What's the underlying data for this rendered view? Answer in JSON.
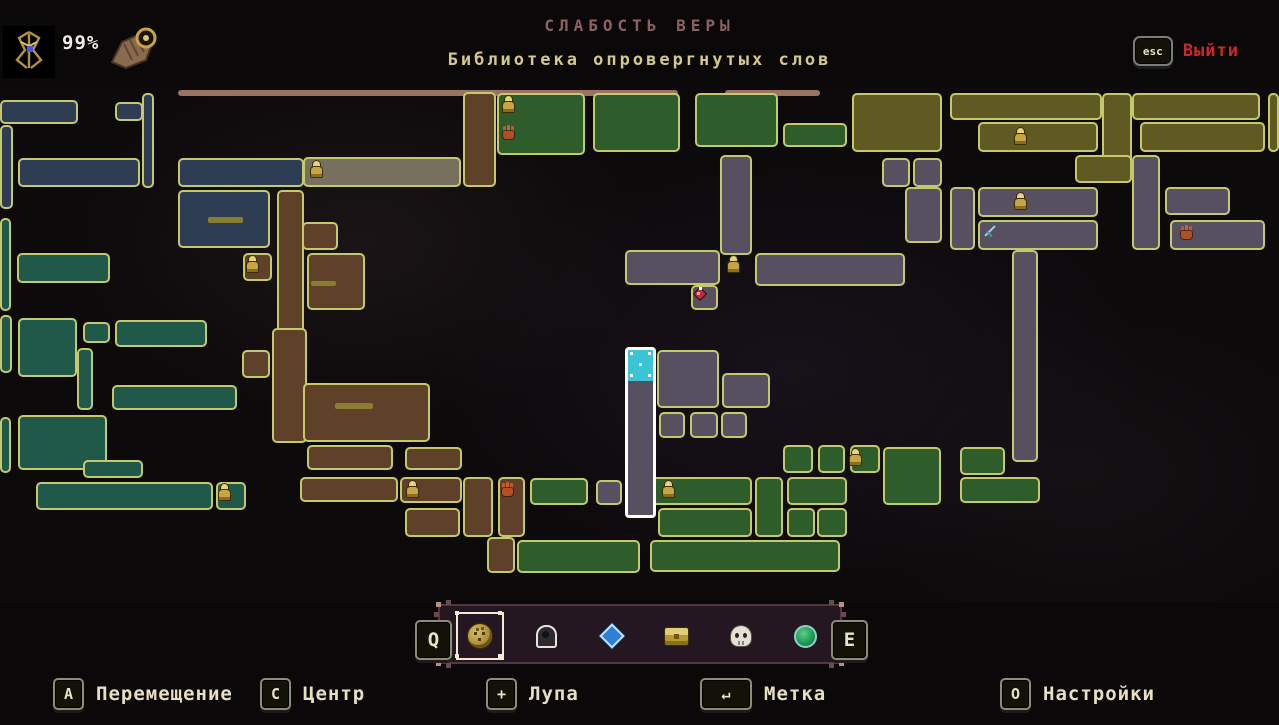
{
  "header": {
    "completion": "99%",
    "zone_title": "СЛАБОСТЬ ВЕРЫ",
    "zone_subtitle": "Библиотека опровергнутых слов",
    "exit_key": "esc",
    "exit_label": "Выйти"
  },
  "legend_bar": {
    "prev_key": "Q",
    "next_key": "E",
    "tabs": [
      {
        "name": "coin-marker",
        "selected": true
      },
      {
        "name": "hooded-figure-marker",
        "selected": false
      },
      {
        "name": "diamond-marker",
        "selected": false
      },
      {
        "name": "chest-marker",
        "selected": false
      },
      {
        "name": "skull-marker",
        "selected": false
      },
      {
        "name": "orb-marker",
        "selected": false
      }
    ]
  },
  "hints": [
    {
      "key": "A",
      "label": "Перемещение",
      "wide": false
    },
    {
      "key": "C",
      "label": "Центр",
      "wide": false
    },
    {
      "key": "+",
      "label": "Лупа",
      "wide": false
    },
    {
      "key": "↵",
      "label": "Метка",
      "wide": true
    },
    {
      "key": "O",
      "label": "Настройки",
      "wide": false
    }
  ],
  "map": {
    "palette": {
      "navy": "#2e3c54",
      "teal": "#20584a",
      "green": "#2e5c2b",
      "olive": "#5f5a21",
      "brown": "#5f4029",
      "purple": "#565060",
      "gray": "#78705f",
      "salmon": "#9c7265",
      "border": "#c6c86c",
      "teleport": "#3cc4d6",
      "player_outline": "#ffffff"
    },
    "rooms": [
      [
        178,
        2,
        500,
        6,
        "salmon"
      ],
      [
        725,
        2,
        95,
        6,
        "salmon"
      ],
      [
        0,
        12,
        78,
        24,
        "navy"
      ],
      [
        115,
        14,
        28,
        19,
        "navy"
      ],
      [
        142,
        5,
        12,
        95,
        "navy"
      ],
      [
        0,
        37,
        13,
        84,
        "navy"
      ],
      [
        18,
        70,
        122,
        29,
        "navy"
      ],
      [
        178,
        70,
        126,
        29,
        "navy"
      ],
      [
        178,
        102,
        92,
        58,
        "navy"
      ],
      [
        208,
        129,
        35,
        6,
        "dash"
      ],
      [
        0,
        130,
        11,
        93,
        "teal"
      ],
      [
        17,
        165,
        93,
        30,
        "teal"
      ],
      [
        0,
        227,
        12,
        58,
        "teal"
      ],
      [
        18,
        230,
        59,
        59,
        "teal"
      ],
      [
        83,
        234,
        27,
        21,
        "teal"
      ],
      [
        115,
        232,
        92,
        27,
        "teal"
      ],
      [
        77,
        260,
        16,
        62,
        "teal"
      ],
      [
        112,
        297,
        125,
        25,
        "teal"
      ],
      [
        18,
        327,
        89,
        55,
        "teal"
      ],
      [
        0,
        329,
        11,
        56,
        "teal"
      ],
      [
        83,
        372,
        60,
        18,
        "teal"
      ],
      [
        36,
        394,
        177,
        28,
        "teal"
      ],
      [
        216,
        394,
        30,
        28,
        "teal"
      ],
      [
        303,
        69,
        158,
        30,
        "gray"
      ],
      [
        463,
        4,
        33,
        95,
        "brown"
      ],
      [
        498,
        34,
        30,
        31,
        "brown"
      ],
      [
        277,
        102,
        27,
        150,
        "brown"
      ],
      [
        302,
        134,
        36,
        28,
        "brown"
      ],
      [
        307,
        165,
        58,
        57,
        "brown"
      ],
      [
        311,
        193,
        25,
        5,
        "dash"
      ],
      [
        243,
        165,
        29,
        28,
        "brown"
      ],
      [
        242,
        262,
        28,
        28,
        "brown"
      ],
      [
        272,
        240,
        35,
        115,
        "brown"
      ],
      [
        303,
        295,
        127,
        59,
        "brown"
      ],
      [
        335,
        315,
        38,
        6,
        "dash"
      ],
      [
        307,
        357,
        86,
        25,
        "brown"
      ],
      [
        405,
        359,
        57,
        23,
        "brown"
      ],
      [
        300,
        389,
        98,
        25,
        "brown"
      ],
      [
        400,
        389,
        62,
        26,
        "brown"
      ],
      [
        405,
        420,
        55,
        29,
        "brown"
      ],
      [
        463,
        389,
        30,
        60,
        "brown"
      ],
      [
        498,
        389,
        27,
        60,
        "brown"
      ],
      [
        487,
        449,
        28,
        36,
        "brown"
      ],
      [
        497,
        5,
        88,
        62,
        "green"
      ],
      [
        593,
        5,
        87,
        59,
        "green"
      ],
      [
        695,
        5,
        83,
        54,
        "green"
      ],
      [
        783,
        35,
        64,
        24,
        "green"
      ],
      [
        852,
        5,
        90,
        59,
        "olive"
      ],
      [
        950,
        5,
        152,
        27,
        "olive"
      ],
      [
        1132,
        5,
        128,
        27,
        "olive"
      ],
      [
        978,
        34,
        120,
        30,
        "olive"
      ],
      [
        1102,
        5,
        30,
        90,
        "olive"
      ],
      [
        1140,
        34,
        125,
        30,
        "olive"
      ],
      [
        1075,
        67,
        57,
        28,
        "olive"
      ],
      [
        1268,
        5,
        11,
        59,
        "olive"
      ],
      [
        720,
        67,
        32,
        100,
        "purple"
      ],
      [
        755,
        165,
        150,
        33,
        "purple"
      ],
      [
        691,
        197,
        27,
        25,
        "purple"
      ],
      [
        625,
        162,
        95,
        35,
        "purple"
      ],
      [
        882,
        70,
        28,
        29,
        "purple"
      ],
      [
        913,
        70,
        29,
        29,
        "purple"
      ],
      [
        950,
        99,
        25,
        63,
        "purple"
      ],
      [
        978,
        99,
        120,
        30,
        "purple"
      ],
      [
        978,
        132,
        120,
        30,
        "purple"
      ],
      [
        905,
        99,
        37,
        56,
        "purple"
      ],
      [
        1132,
        67,
        28,
        95,
        "purple"
      ],
      [
        1165,
        99,
        65,
        28,
        "purple"
      ],
      [
        1170,
        132,
        95,
        30,
        "purple"
      ],
      [
        1012,
        162,
        26,
        212,
        "purple"
      ],
      [
        657,
        262,
        62,
        58,
        "purple"
      ],
      [
        722,
        285,
        48,
        35,
        "purple"
      ],
      [
        659,
        324,
        26,
        26,
        "purple"
      ],
      [
        690,
        324,
        28,
        26,
        "purple"
      ],
      [
        721,
        324,
        26,
        26,
        "purple"
      ],
      [
        596,
        392,
        26,
        25,
        "purple"
      ],
      [
        530,
        390,
        58,
        27,
        "green"
      ],
      [
        650,
        389,
        102,
        28,
        "green"
      ],
      [
        755,
        389,
        28,
        60,
        "green"
      ],
      [
        787,
        389,
        60,
        28,
        "green"
      ],
      [
        883,
        359,
        58,
        58,
        "green"
      ],
      [
        960,
        359,
        45,
        28,
        "green"
      ],
      [
        960,
        389,
        80,
        26,
        "green"
      ],
      [
        783,
        357,
        30,
        28,
        "green"
      ],
      [
        818,
        357,
        27,
        28,
        "green"
      ],
      [
        850,
        357,
        30,
        28,
        "green"
      ],
      [
        658,
        420,
        94,
        29,
        "green"
      ],
      [
        787,
        420,
        28,
        29,
        "green"
      ],
      [
        817,
        420,
        30,
        29,
        "green"
      ],
      [
        517,
        452,
        123,
        33,
        "green"
      ],
      [
        650,
        452,
        190,
        32,
        "green"
      ]
    ],
    "icons": [
      [
        "altar",
        310,
        73
      ],
      [
        "altar",
        502,
        8
      ],
      [
        "altar",
        246,
        168
      ],
      [
        "altar",
        1014,
        40
      ],
      [
        "altar",
        1014,
        105
      ],
      [
        "altar",
        727,
        168
      ],
      [
        "altar",
        218,
        396
      ],
      [
        "altar",
        406,
        393
      ],
      [
        "altar",
        662,
        393
      ],
      [
        "altar",
        849,
        361
      ],
      [
        "hand",
        502,
        38
      ],
      [
        "hand",
        1180,
        138
      ],
      [
        "hand",
        501,
        395
      ],
      [
        "gem",
        694,
        199
      ],
      [
        "sword",
        982,
        136
      ]
    ],
    "player": {
      "x": 625,
      "y": 259,
      "w": 31,
      "h": 171
    },
    "icon_meaning": {
      "altar": "prie-dieu-checkpoint-icon",
      "hand": "hand-icon",
      "gem": "gem-icon",
      "sword": "sword-icon"
    }
  }
}
